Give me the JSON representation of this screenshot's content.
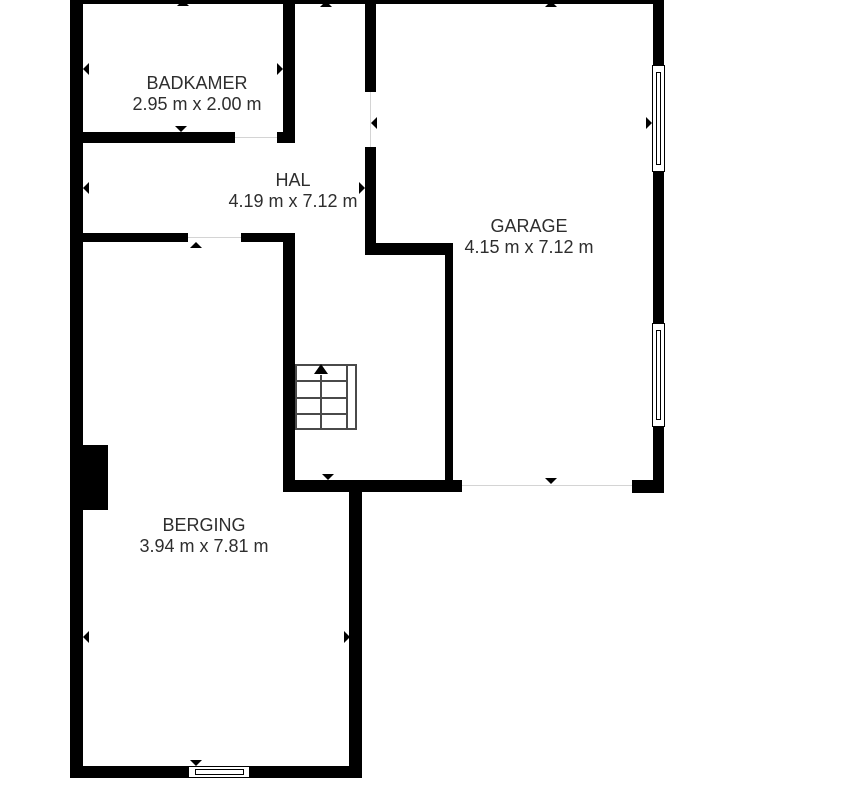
{
  "floorplan": {
    "colors": {
      "background": "#ffffff",
      "walls": "#000000",
      "stair_lines": "#4a4a4a",
      "threshold_lines": "#d4d4d4",
      "text": "#2e2e2e"
    },
    "rooms": [
      {
        "id": "badkamer",
        "name": "BADKAMER",
        "dimensions": "2.95 m x 2.00 m"
      },
      {
        "id": "hal",
        "name": "HAL",
        "dimensions": "4.19 m x 7.12 m"
      },
      {
        "id": "garage",
        "name": "GARAGE",
        "dimensions": "4.15 m x 7.12 m"
      },
      {
        "id": "berging",
        "name": "BERGING",
        "dimensions": "3.94 m x 7.81 m"
      }
    ],
    "stairs": {
      "direction": "up"
    },
    "windows": {
      "count": 3
    }
  }
}
